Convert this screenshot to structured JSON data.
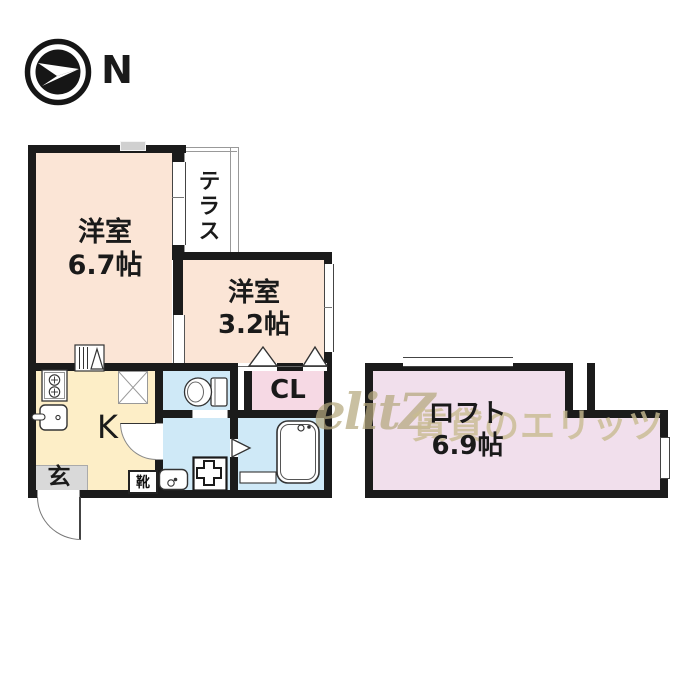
{
  "compass": {
    "label": "N"
  },
  "watermark": {
    "logo": "elitZ",
    "text": "賃貸のエリッツ"
  },
  "rooms": {
    "western_67": {
      "name": "洋室",
      "area": "6.7帖"
    },
    "terrace": {
      "name": "テラス"
    },
    "western_32": {
      "name": "洋室",
      "area": "3.2帖"
    },
    "closet": {
      "label": "CL"
    },
    "kitchen": {
      "label": "K"
    },
    "entrance": {
      "label": "玄"
    },
    "shoe_box": {
      "label": "靴"
    },
    "loft": {
      "name": "ロフト",
      "area": "6.9帖"
    }
  },
  "colors": {
    "wall": "#1b1b1b",
    "western_room": "#fbe5d6",
    "kitchen": "#fdeec7",
    "wet_area": "#cfe9f7",
    "closet": "#f6d9e4",
    "loft": "#f1dfec",
    "entrance_floor": "#d9d9d9",
    "watermark": "#c9bc92"
  }
}
